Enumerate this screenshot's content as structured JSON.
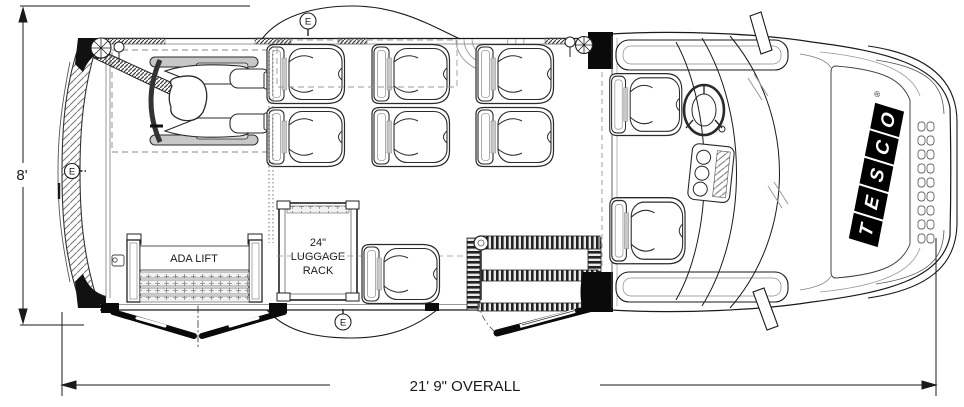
{
  "drawing": {
    "type": "vehicle-floor-plan",
    "vehicle": "TESCO shuttle bus plan view"
  },
  "dimensions": {
    "body_width": "8'",
    "overall": "21' 9\" OVERALL"
  },
  "ada_lift": {
    "label": "ADA LIFT"
  },
  "luggage_rack": {
    "size": "24\"",
    "word1": "LUGGAGE",
    "word2": "RACK"
  },
  "exit": {
    "label": "E"
  },
  "logo": {
    "letters": [
      "T",
      "E",
      "S",
      "C",
      "O"
    ],
    "registered": "®"
  },
  "colors": {
    "line": "#1a1a1a",
    "light_line": "#8a8a8a",
    "hatch": "#777777",
    "fill": "#ffffff",
    "logo_bg": "#000000",
    "logo_text": "#ffffff",
    "wheel_gray": "#c8c8c8"
  }
}
